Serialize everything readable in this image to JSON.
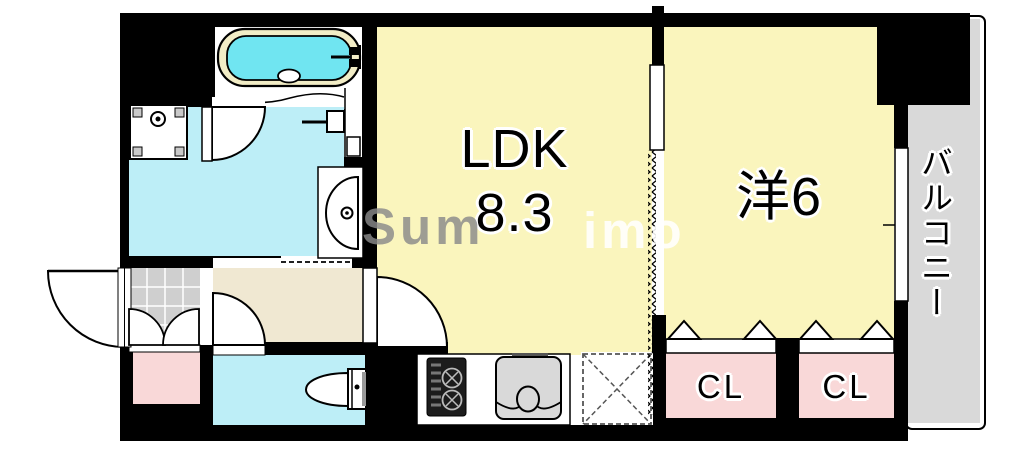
{
  "floorplan": {
    "rooms": {
      "ldk": {
        "name": "LDK",
        "area": "8.3"
      },
      "western": {
        "name": "洋6"
      },
      "balcony": {
        "name": "バルコニー"
      },
      "closet_left": {
        "name": "CL"
      },
      "closet_right": {
        "name": "CL"
      }
    },
    "watermark": {
      "left": "Sum",
      "right": "imo"
    },
    "colors": {
      "wall": "#000000",
      "room_yellow": "#faf5bd",
      "water_cyan": "#bdeef7",
      "tub_water": "#70e5f1",
      "tub_rim": "#f2edc6",
      "hall_beige": "#f0e8d2",
      "closet_pink": "#f9d8d8",
      "balcony_gray": "#d9d9d9",
      "genkan_gray": "#cfcfcf",
      "sink_gray": "#d9d9d9",
      "stove_dark": "#1c1c1c"
    }
  }
}
